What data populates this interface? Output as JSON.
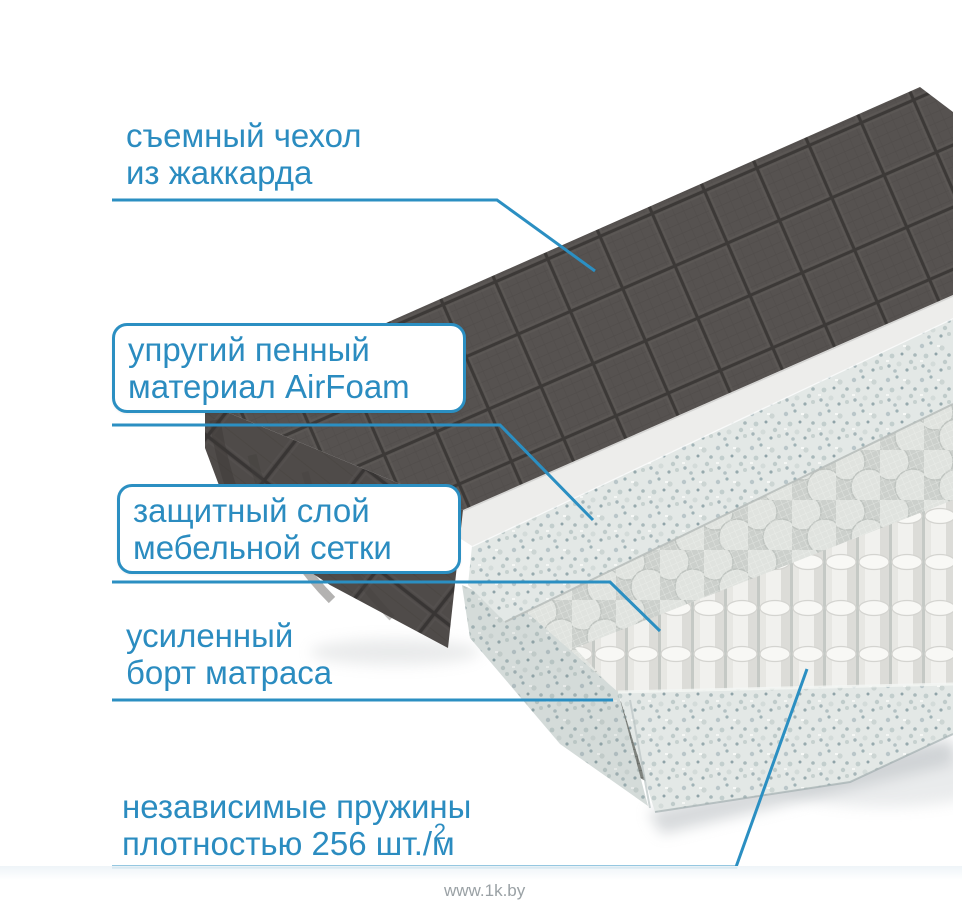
{
  "labels": {
    "cover": {
      "line1": "съемный чехол",
      "line2": "из жаккарда"
    },
    "foam": {
      "line1": "упругий пенный",
      "line2": "материал AirFoam"
    },
    "mesh": {
      "line1": "защитный слой",
      "line2": "мебельной сетки"
    },
    "edge": {
      "line1": "усиленный",
      "line2": "борт матраса"
    },
    "springs": {
      "line1": "независимые пружины",
      "line2": "плотностью 256 шт./м",
      "sup": "2"
    }
  },
  "watermark": "www.1k.by",
  "colors": {
    "accent": "#2b8fc2",
    "cover_fabric": "#565250",
    "cover_seam": "#3c3937",
    "foam_speckle_base": "#e3e8e6",
    "spring_white": "#f1f1ee",
    "background": "#ffffff"
  }
}
